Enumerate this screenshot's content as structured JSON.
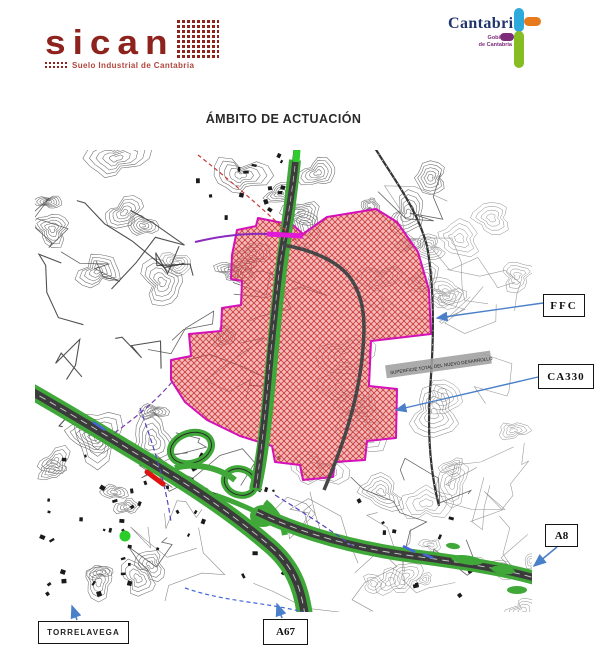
{
  "header": {
    "sican": {
      "wordmark": "sican",
      "tagline": "Suelo Industrial de Cantabria"
    },
    "cantabria": {
      "name": "Cantabria",
      "gov_line1": "Gobierno",
      "gov_line2": "de Cantabria"
    }
  },
  "title": "ÁMBITO DE ACTUACIÓN",
  "map": {
    "area_label": "SUPERFICIE TOTAL DEL NUEVO DESARROLLO",
    "callouts": {
      "ffc": "FFC",
      "ca330": "CA330",
      "a8": "A8",
      "torrelavega": "TORRELAVEGA",
      "a67": "A67"
    },
    "colors": {
      "zone_fill": "#ee7b7b",
      "zone_border": "#d410b8",
      "highway_green": "#3fa838",
      "arrow_blue": "#4a7fc9",
      "hazard_red": "#e01313",
      "sican_maroon": "#8e231d",
      "cantabria_navy": "#20356e"
    }
  }
}
